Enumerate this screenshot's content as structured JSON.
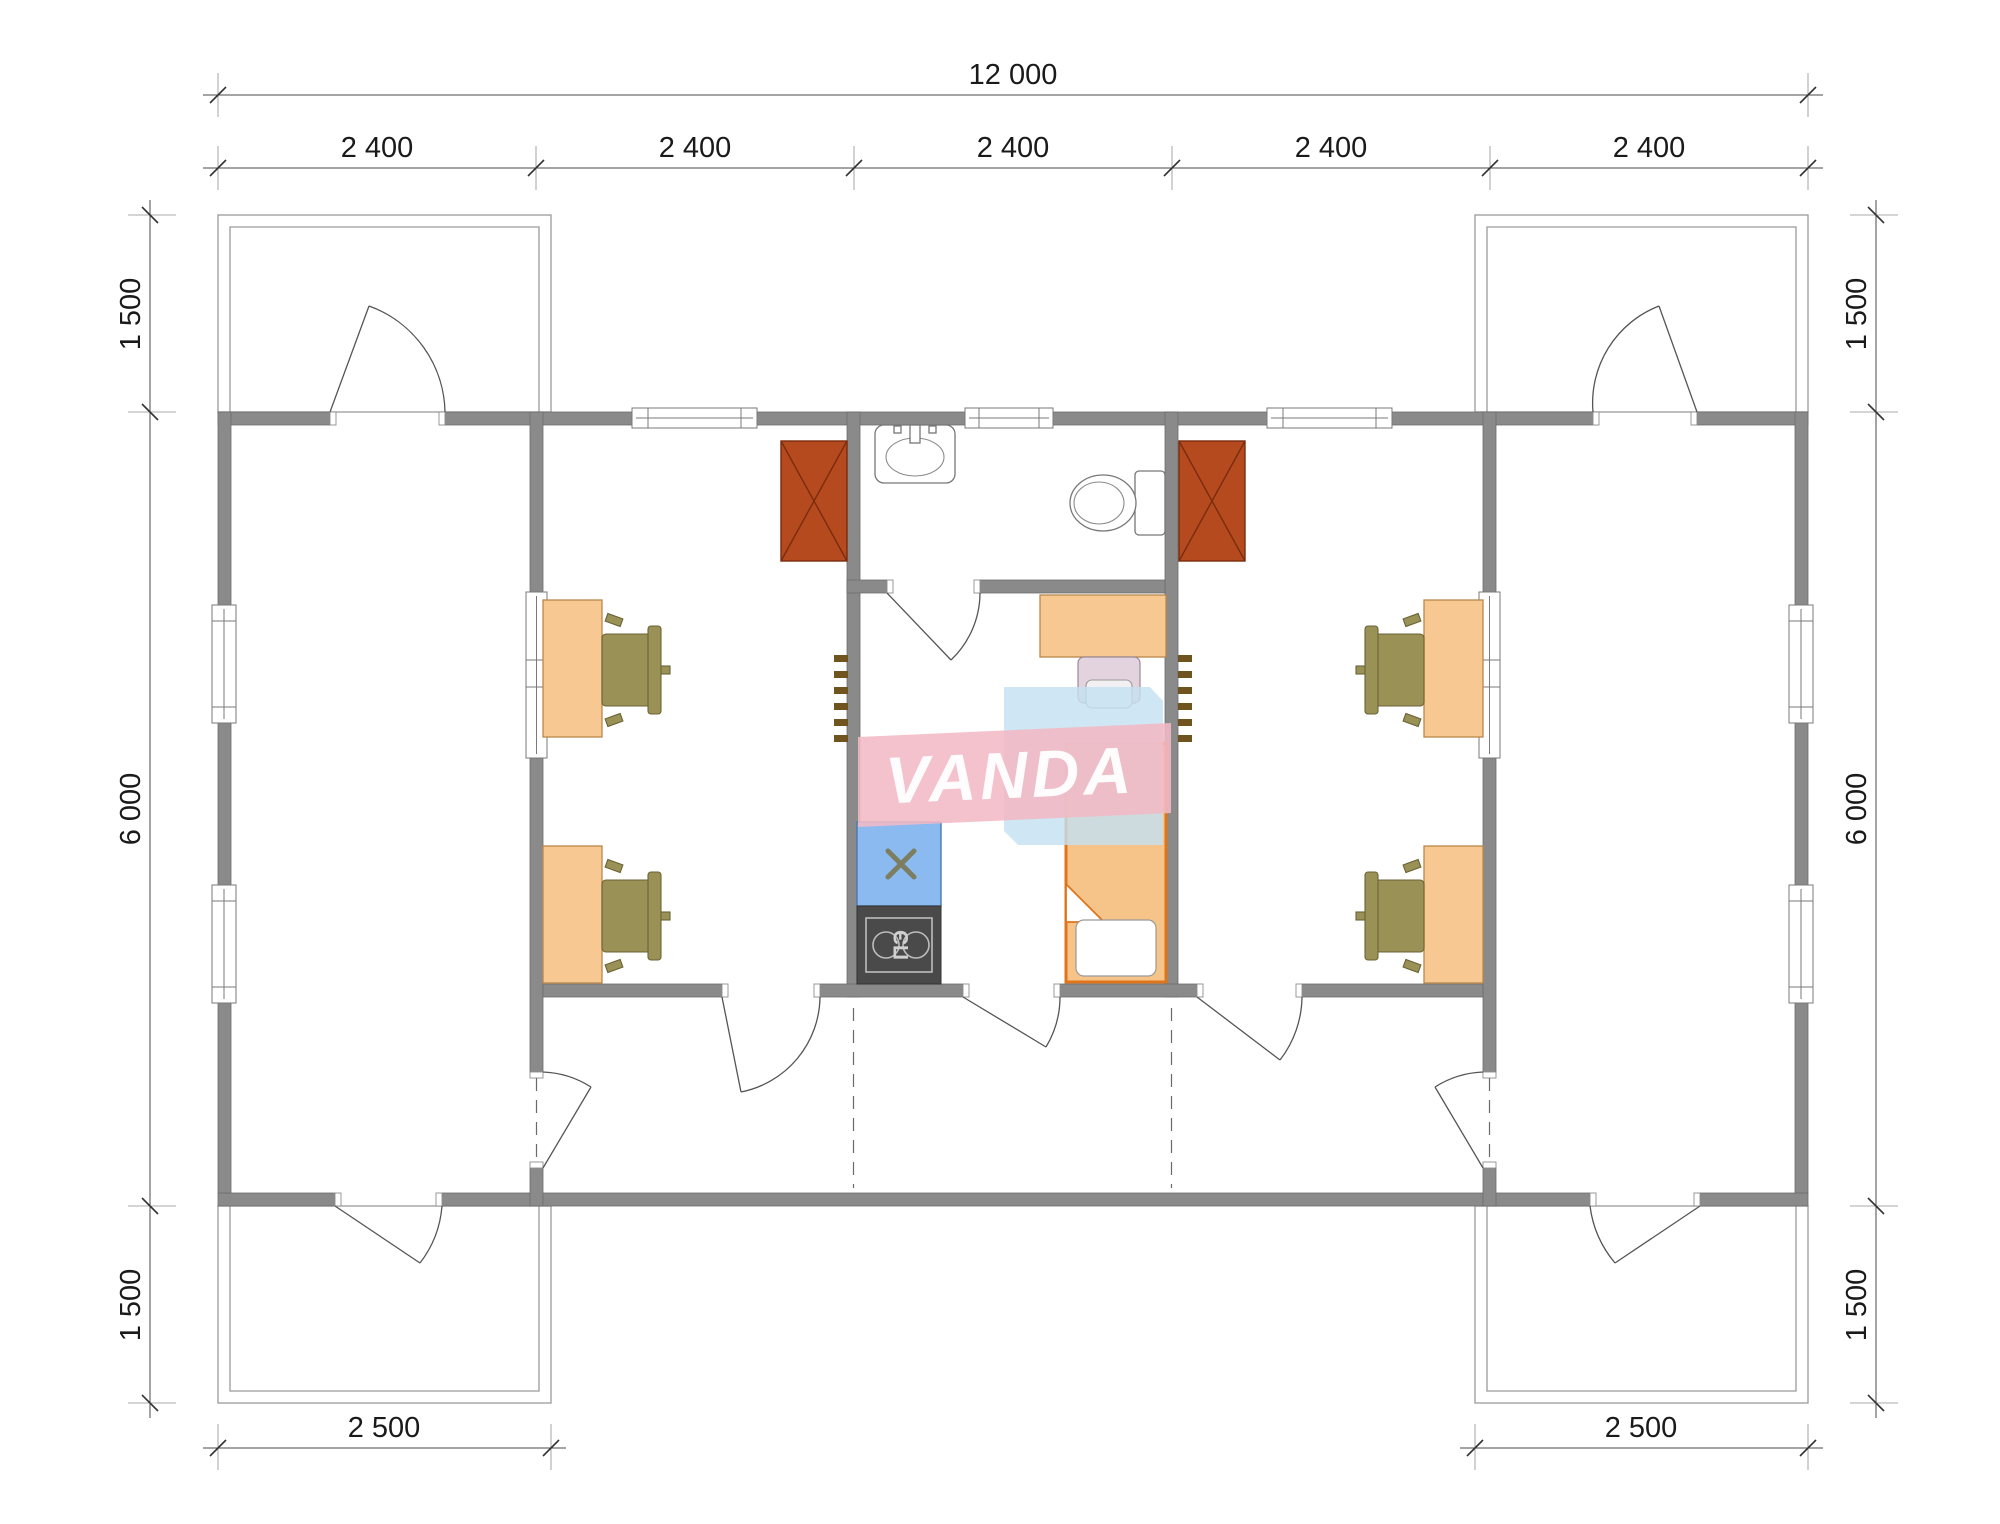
{
  "watermark": {
    "text": "VANDA",
    "pink_color": "#f2b9c5",
    "blue_color": "#c4e0f2"
  },
  "labels": {
    "electric_stove": "ПЭ"
  },
  "dims": {
    "total": "12 000",
    "modules": [
      "2 400",
      "2 400",
      "2 400",
      "2 400",
      "2 400"
    ],
    "left": [
      "1 500",
      "6 000",
      "1 500"
    ],
    "right": [
      "1 500",
      "6 000",
      "1 500"
    ],
    "bottom": [
      "2 500",
      "2 500"
    ]
  },
  "colors": {
    "wall": "#8a8a8a",
    "stove_red": "#b44a1d",
    "desk": "#f7c891",
    "chair_olive": "#9a9156",
    "chair_pink": "#e3d3de",
    "kitchen_blue": "#8abaf0",
    "stove_dark": "#4a4a4a",
    "bed_fill": "#f6c488",
    "bed_border": "#de751b",
    "ladder": "#6f5420"
  }
}
